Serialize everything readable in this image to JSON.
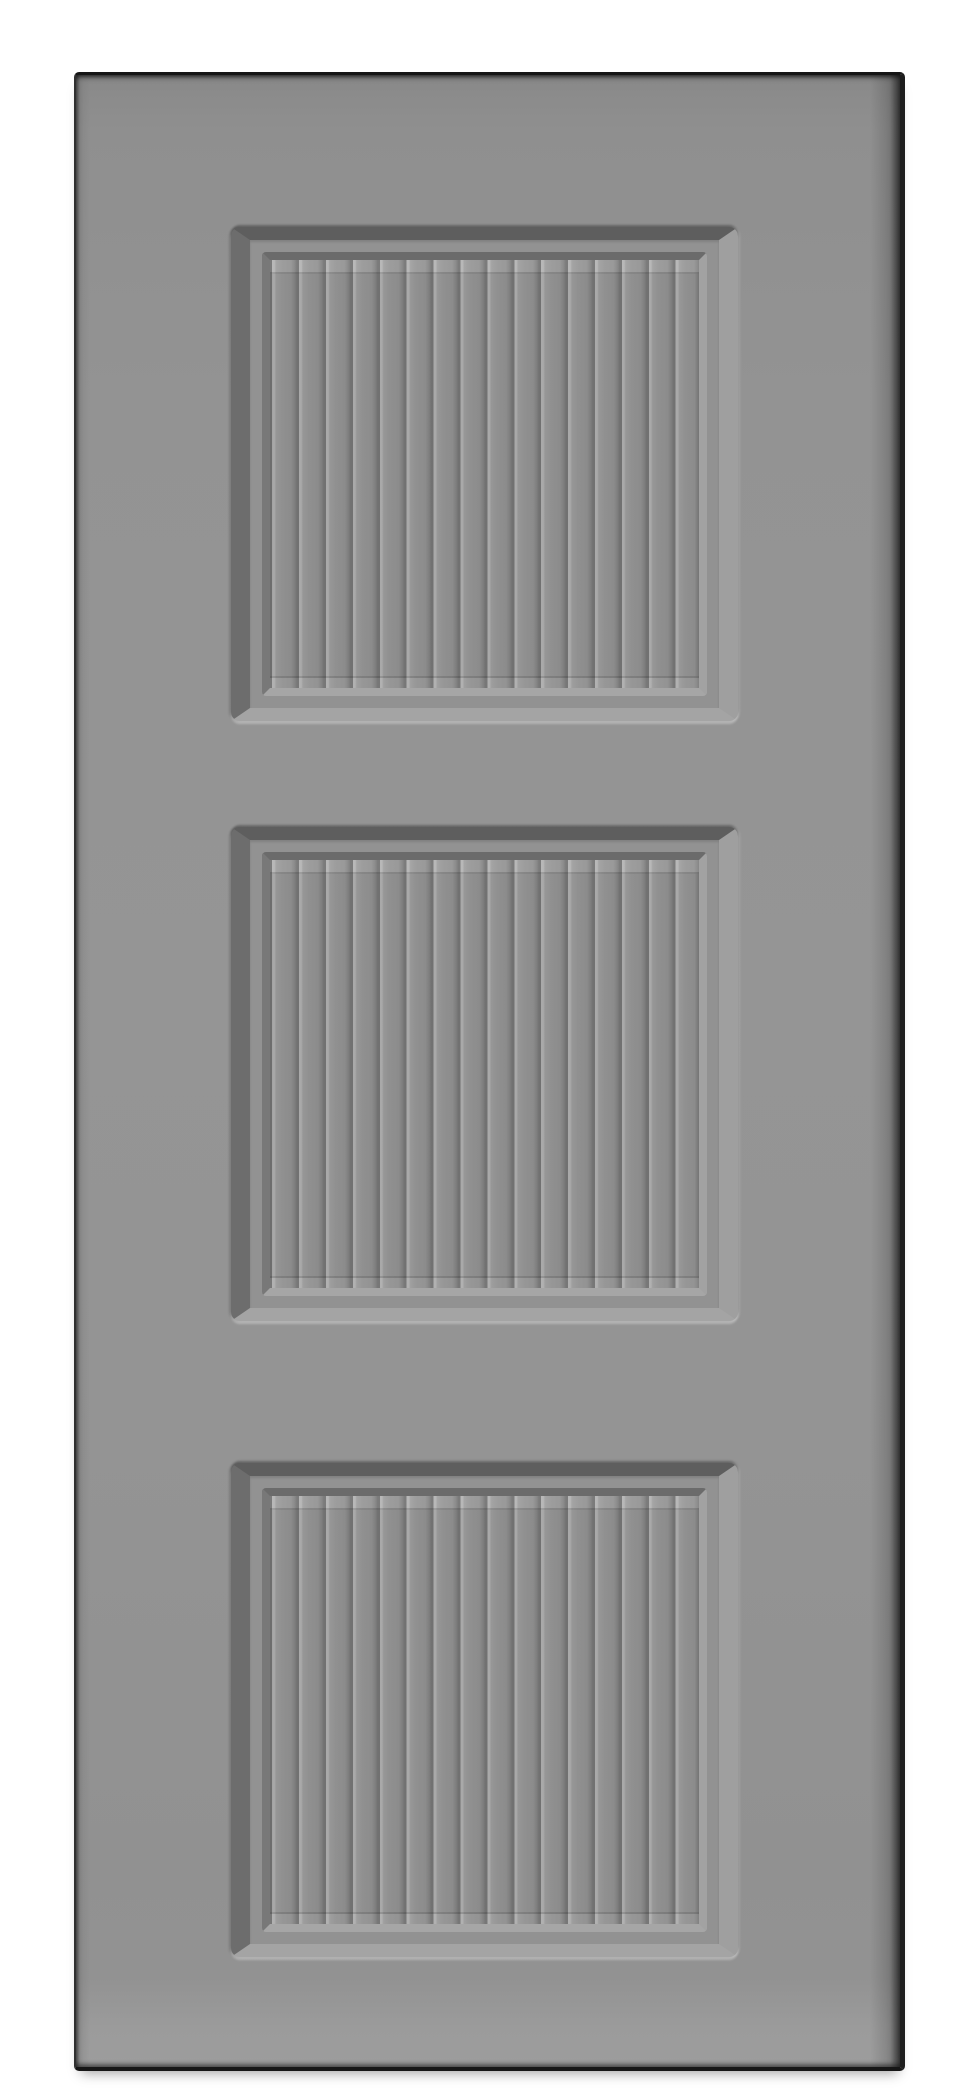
{
  "image": {
    "type": "product-photo",
    "alt": "Gray painted three-panel interior door, front view on a white background; each square recessed panel is filled with vertical beadboard slats"
  },
  "door": {
    "panel_count": 3,
    "slats_per_panel": 16,
    "panels": [
      {
        "id": "top-panel"
      },
      {
        "id": "middle-panel"
      },
      {
        "id": "bottom-panel"
      }
    ]
  },
  "colors": {
    "background": "#ffffff",
    "door-face": "#939393",
    "door-face-dark": "#8a8a8a",
    "door-face-light": "#9b9b9b",
    "door-outline": "#161616",
    "door-edge-left": "#303030",
    "door-edge-right": "#1d1d1d",
    "panel-shadow-top": "#5e5e5e",
    "panel-shadow-left": "#6d6d6d",
    "panel-highlight-right": "#9f9f9f",
    "panel-highlight-bottom": "#a4a4a4",
    "frame-flat": "#929292",
    "step-shadow-top": "#6b6b6b",
    "step-shadow-left": "#787878",
    "step-light-right": "#a2a2a2",
    "step-light-bottom": "#a6a6a6",
    "groove-dark": "#717171",
    "groove-light": "#a9a9a9",
    "slat-face": "#909090"
  }
}
